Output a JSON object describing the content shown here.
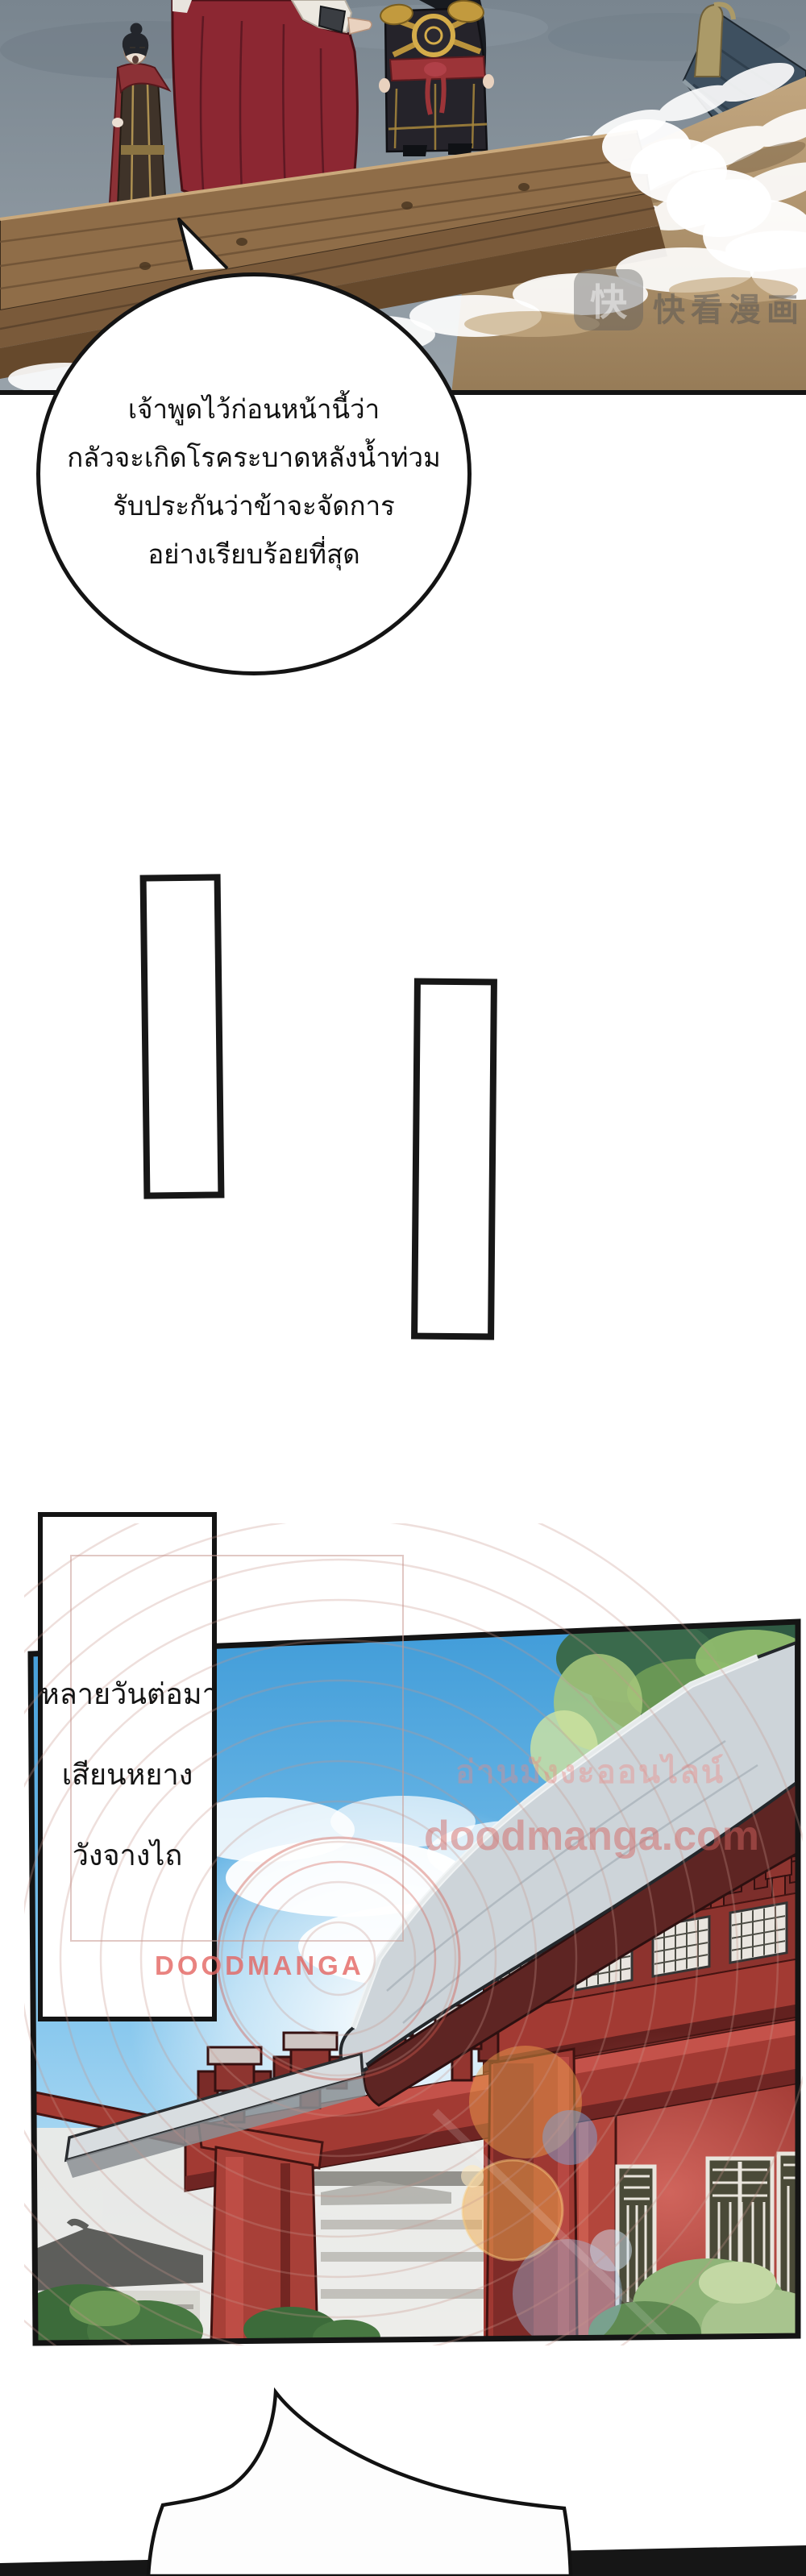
{
  "panel1": {
    "watermark": {
      "logo_glyph": "快",
      "label": "快看漫画"
    }
  },
  "bubble1": {
    "lines": [
      "เจ้าพูดไว้ก่อนหน้านี้ว่า",
      "กลัวจะเกิดโรคระบาดหลังน้ำท่วม",
      "รับประกันว่าข้าจะจัดการ",
      "อย่างเรียบร้อยที่สุด"
    ]
  },
  "caption": {
    "lines": [
      "หลายวันต่อมา",
      "เสียนหยาง",
      "วังจางไถ"
    ]
  },
  "panel2": {
    "watermarks": {
      "thai_overlay": "อ่านมังงะออนไลน์",
      "site": "doodmanga.com",
      "brand": "DOODMANGA"
    }
  },
  "colors": {
    "page_background": "#ffffff",
    "panel_border": "#141414",
    "storm_sky": "#7e8994",
    "flood_water": "#b3956f",
    "cape_red": "#8c2732",
    "day_sky": "#4aa7e2",
    "palace_red": "#a23a33",
    "watermark_pink": "#e06460",
    "bottom_panel_dark": "#161616"
  }
}
